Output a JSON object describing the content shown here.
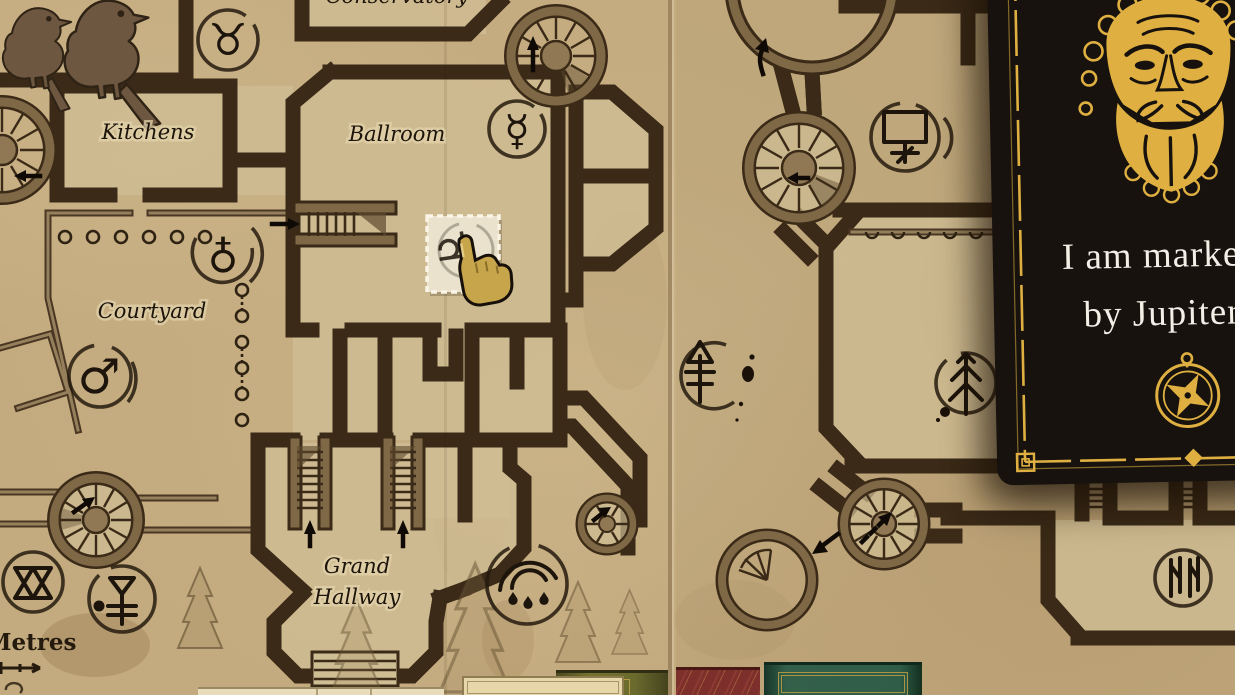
{
  "map": {
    "labels": {
      "kitchens": "Kitchens",
      "ballroom": "Ballroom",
      "courtyard": "Courtyard",
      "grand_hall_1": "Grand",
      "grand_hall_2": "Hallway",
      "conservatory": "Conservatory",
      "scale": "Metres"
    },
    "glyphs": {
      "taurus": "♉",
      "mercury": "☿",
      "mars": "♂",
      "antimony": "♁",
      "jupiter": "♃"
    },
    "markers": [
      "taurus-symbol",
      "mercury-symbol",
      "antimony-symbol",
      "mars-symbol",
      "double-triangle-symbol",
      "sulfur-rune-symbol",
      "crescent-drops-symbol",
      "tree-ink-symbol",
      "easel-symbol",
      "pine-rune-symbol",
      "hall-rune-symbol"
    ],
    "highlight": {
      "glyph": "♃",
      "name": "jupiter-placement-tile"
    }
  },
  "clue_card": {
    "line1": "I am marked",
    "line2": "by Jupiter",
    "face_icon": "jupiter-face",
    "footer_icon": "compass"
  },
  "shelf": [
    "papers",
    "tan-card",
    "olive-book",
    "maroon-book",
    "green-book"
  ],
  "colors": {
    "parchment": "#c4ab7f",
    "wall": "#7f6845",
    "ink": "#1d150c",
    "card": "#17120d",
    "gold": "#dfb041",
    "highlight_tile": "#eae2cd"
  }
}
